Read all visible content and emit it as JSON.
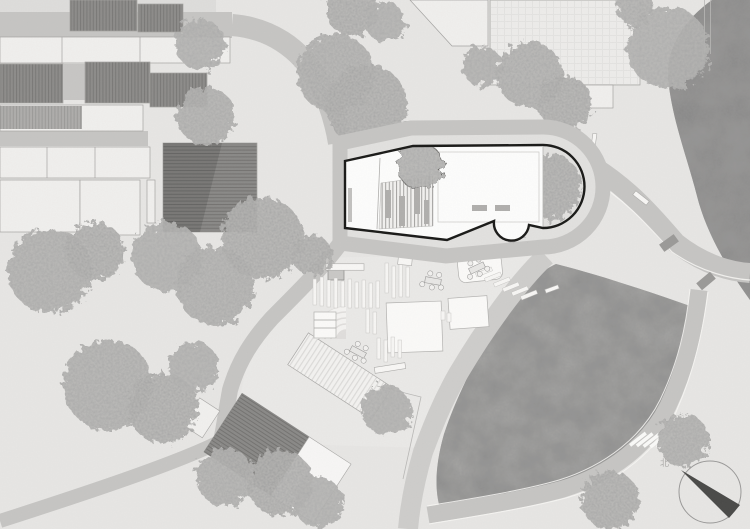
{
  "figure": {
    "type_label": "site plan",
    "north_label": "北"
  },
  "palette": {
    "paper": "#e7e6e4",
    "plaza": "#eae9e7",
    "road": "#c6c5c3",
    "road_light": "#cecdcb",
    "sidewalk": "#e2e1df",
    "lawn": "#a9a8a6",
    "forest": "#9b9a98",
    "tree": "#b6b5b3",
    "context_fill": "#f0efed",
    "context_outline": "#a5a4a2",
    "roof_dark": "#8d8c8a",
    "building_fill": "#fdfdfc",
    "building_outline": "#1a1a18",
    "paving_white": "#f7f6f4",
    "needle": "#4a4a48"
  },
  "scene": {
    "trees": [
      [
        50,
        271,
        42,
        1
      ],
      [
        95,
        251,
        29,
        2
      ],
      [
        167,
        257,
        35,
        3
      ],
      [
        215,
        286,
        39,
        1
      ],
      [
        262,
        238,
        41,
        2
      ],
      [
        200,
        44,
        25,
        3
      ],
      [
        206,
        116,
        29,
        1
      ],
      [
        352,
        10,
        26,
        2
      ],
      [
        385,
        22,
        20,
        3
      ],
      [
        335,
        73,
        39,
        1
      ],
      [
        367,
        106,
        41,
        2
      ],
      [
        482,
        66,
        20,
        3
      ],
      [
        530,
        75,
        33,
        1
      ],
      [
        565,
        103,
        27,
        2
      ],
      [
        668,
        48,
        41,
        3
      ],
      [
        635,
        8,
        18,
        1
      ],
      [
        312,
        255,
        20,
        2
      ],
      [
        386,
        410,
        25,
        3
      ],
      [
        108,
        385,
        45,
        1
      ],
      [
        163,
        408,
        35,
        2
      ],
      [
        194,
        367,
        25,
        3
      ],
      [
        225,
        477,
        29,
        1
      ],
      [
        280,
        483,
        33,
        2
      ],
      [
        318,
        502,
        25,
        3
      ],
      [
        683,
        440,
        26,
        1
      ],
      [
        610,
        500,
        29,
        2
      ]
    ],
    "crosswalks": [
      {
        "x": 353,
        "y": 148.5,
        "dx": 0,
        "dy": 5.5,
        "n": 3,
        "w": 13,
        "h": 3.2,
        "rot": 0
      },
      {
        "x": 354,
        "y": 231,
        "dx": 0,
        "dy": 6,
        "n": 4,
        "w": 15,
        "h": 3.2,
        "rot": 0
      },
      {
        "x": 475,
        "y": 228,
        "dx": 0.5,
        "dy": 5.5,
        "n": 4,
        "w": 24,
        "h": 3,
        "rot": 3
      },
      {
        "x": 533,
        "y": 222.5,
        "dx": 0.5,
        "dy": 5.5,
        "n": 4,
        "w": 24,
        "h": 3,
        "rot": -4
      },
      {
        "x": 629,
        "y": 444,
        "dx": 5,
        "dy": 4.6,
        "n": 5,
        "w": 20,
        "h": 3.5,
        "rot": -38
      }
    ],
    "benches": [
      [
        362,
        141,
        25,
        5,
        -6
      ],
      [
        385,
        248,
        26,
        5,
        -8
      ],
      [
        399,
        239,
        30,
        5,
        2
      ],
      [
        408,
        124,
        28,
        5,
        4
      ],
      [
        454,
        133,
        28,
        5,
        10
      ],
      [
        390,
        368,
        31,
        6,
        -9
      ],
      [
        345,
        267,
        38,
        6.5,
        0
      ],
      [
        641,
        198,
        17,
        5,
        38
      ],
      [
        594,
        140,
        4,
        13,
        8
      ],
      [
        552,
        289,
        14,
        4,
        -20
      ],
      [
        405,
        261,
        14,
        8,
        6
      ]
    ],
    "slats_vertical": [
      [
        313,
        279,
        3.5,
        26
      ],
      [
        320,
        277,
        3.5,
        29
      ],
      [
        327,
        280,
        3.5,
        27
      ],
      [
        334,
        278,
        3.5,
        30
      ],
      [
        341,
        281,
        3.5,
        26
      ],
      [
        348,
        279,
        3.5,
        29
      ],
      [
        355,
        282,
        3.5,
        26
      ],
      [
        362,
        280,
        3.5,
        28
      ],
      [
        369,
        283,
        3.5,
        25
      ],
      [
        376,
        281,
        3.5,
        27
      ],
      [
        385,
        263,
        3.5,
        30
      ],
      [
        392,
        266,
        3.5,
        32
      ],
      [
        399,
        263,
        3.5,
        34
      ],
      [
        406,
        267,
        3.5,
        30
      ],
      [
        366,
        309,
        3.5,
        24
      ],
      [
        373,
        312,
        3.5,
        22
      ],
      [
        377,
        338,
        3.5,
        21
      ],
      [
        384,
        340,
        3.5,
        22
      ],
      [
        391,
        337,
        3.5,
        20
      ],
      [
        398,
        340,
        3.5,
        18
      ],
      [
        441,
        311,
        4,
        9
      ],
      [
        447,
        313,
        4,
        9
      ]
    ],
    "slats_diagonal": [
      [
        484,
        272
      ],
      [
        493,
        277
      ],
      [
        502,
        282
      ],
      [
        511,
        287
      ],
      [
        520,
        291
      ],
      [
        529,
        295
      ]
    ],
    "cars": [
      [
        669,
        243,
        -36
      ],
      [
        706,
        281,
        -40
      ]
    ],
    "tables": [
      [
        358,
        352,
        28
      ],
      [
        433,
        281,
        10
      ],
      [
        477,
        268,
        -25
      ]
    ]
  }
}
